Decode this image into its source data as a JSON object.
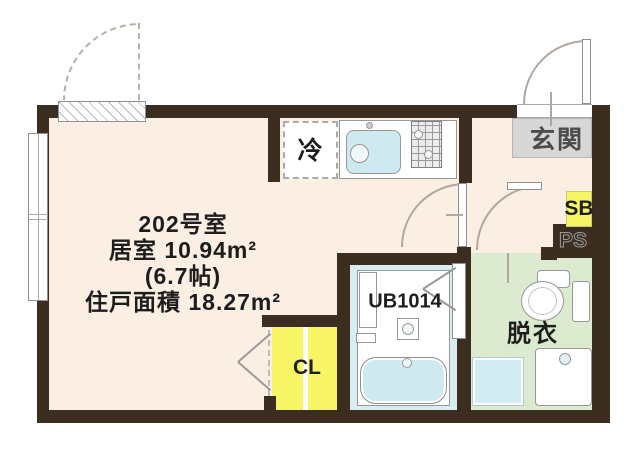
{
  "title": "202号室 間取り図",
  "colors": {
    "wall": "#3b2d20",
    "line": "#b0a8a0",
    "floor-room": "#fbefe3",
    "floor-entrance": "#d7d7d7",
    "floor-dressing": "#dcead0",
    "floor-bath": "#d8ecf1",
    "floor-closet": "#f7f566",
    "fixture-blue": "#cfe9f1",
    "border-gray": "#8f8f8f"
  },
  "room_info": {
    "room_no": "202号室",
    "living_area": "居室 10.94m²",
    "tatami": "(6.7帖)",
    "unit_area": "住戸面積 18.27m²"
  },
  "labels": {
    "entrance": "玄関",
    "shoe_box": "SB",
    "pipe_space": "PS",
    "refrigerator": "冷",
    "unit_bath": "UB1014",
    "dressing_room": "脱衣",
    "closet": "CL"
  }
}
